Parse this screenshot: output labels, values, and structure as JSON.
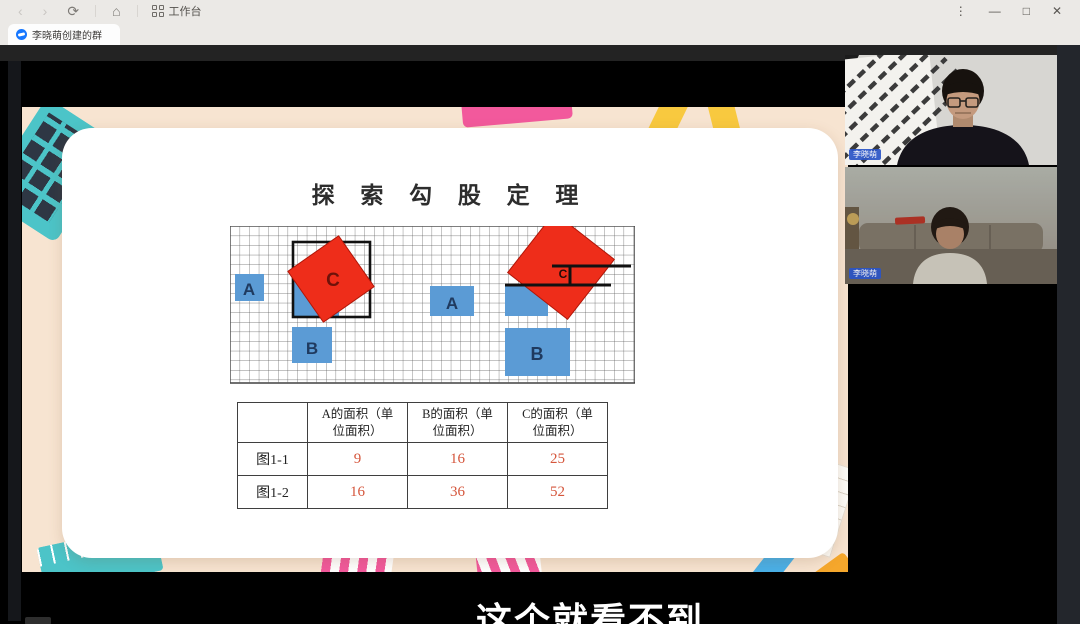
{
  "window": {
    "workspace_label": "工作台",
    "tab_label": "李晓萌创建的群",
    "icons": {
      "back": "‹",
      "forward": "›",
      "refresh": "⟳",
      "home": "⌂",
      "more": "⋮",
      "minimize": "—",
      "maximize": "□",
      "close": "✕"
    }
  },
  "slide": {
    "title": "探 索 勾 股 定 理"
  },
  "figure": {
    "left": {
      "a": "A",
      "b": "B",
      "c": "C"
    },
    "right": {
      "a": "A",
      "b": "B",
      "c": "C"
    }
  },
  "table": {
    "headers": [
      "",
      "A的面积（单位面积）",
      "B的面积（单位面积）",
      "C的面积（单位面积）"
    ],
    "rows": [
      {
        "label": "图1-1",
        "a": "9",
        "b": "16",
        "c": "25"
      },
      {
        "label": "图1-2",
        "a": "16",
        "b": "36",
        "c": "52"
      }
    ]
  },
  "videos": [
    {
      "name": "李晓萌"
    },
    {
      "name": "李晓萌"
    }
  ],
  "subtitle": "这个就看不到",
  "colors": {
    "square_blue": "#5b9bd5",
    "square_red": "#ee2d1a",
    "number_red": "#d5563c",
    "tab_icon_blue": "#1677ff",
    "name_label_bg": "#2b55c8"
  }
}
